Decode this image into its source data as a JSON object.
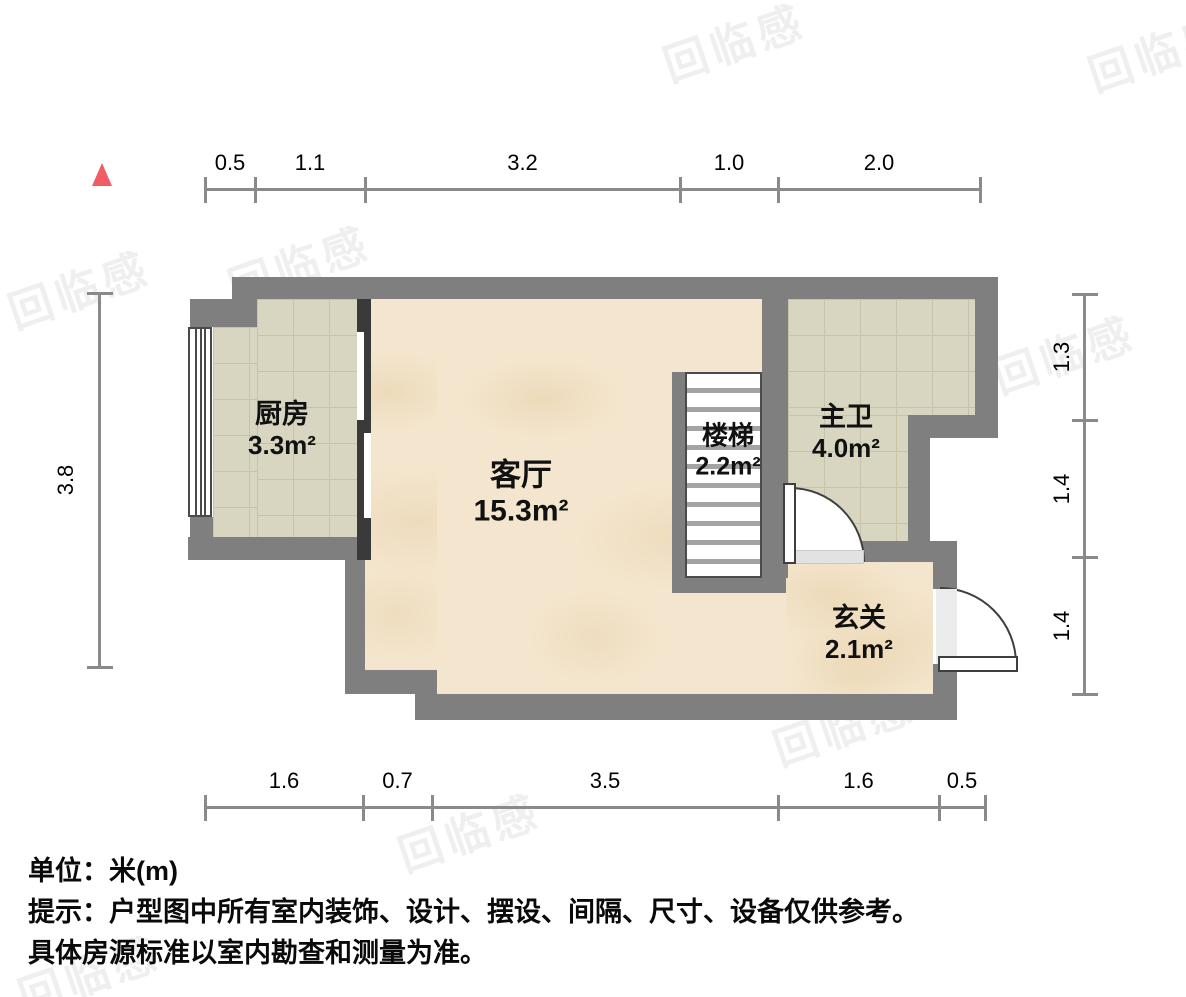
{
  "plan": {
    "type": "apartment-floorplan",
    "unit": "米(m)"
  },
  "rooms": [
    {
      "id": "kitchen",
      "name": "厨房",
      "area": "3.3m²"
    },
    {
      "id": "living",
      "name": "客厅",
      "area": "15.3m²"
    },
    {
      "id": "stairs",
      "name": "楼梯",
      "area": "2.2m²"
    },
    {
      "id": "bathroom",
      "name": "主卫",
      "area": "4.0m²"
    },
    {
      "id": "entry",
      "name": "玄关",
      "area": "2.1m²"
    }
  ],
  "dimensions": {
    "top": [
      "0.5",
      "1.1",
      "3.2",
      "1.0",
      "2.0"
    ],
    "bottom": [
      "1.6",
      "0.7",
      "3.5",
      "1.6",
      "0.5"
    ],
    "left": [
      "3.8"
    ],
    "right": [
      "1.3",
      "1.4",
      "1.4"
    ]
  },
  "notes": {
    "unit": "单位：米(m)",
    "tip1": "提示：户型图中所有室内装饰、设计、摆设、间隔、尺寸、设备仅供参考。",
    "tip2": "具体房源标准以室内勘查和测量为准。"
  },
  "watermark": {
    "text": "回临感"
  },
  "colors": {
    "wall": "#7f7f7f",
    "inner_divider": "#3a3a3a",
    "tile_floor": "#d8d6c1",
    "tile_grid": "#c6c3a9",
    "marble_floor": "#f4e6ce",
    "dimension_line": "#8a8a8a",
    "north_marker": "#f25c64",
    "threshold": "#e2e2e2"
  }
}
